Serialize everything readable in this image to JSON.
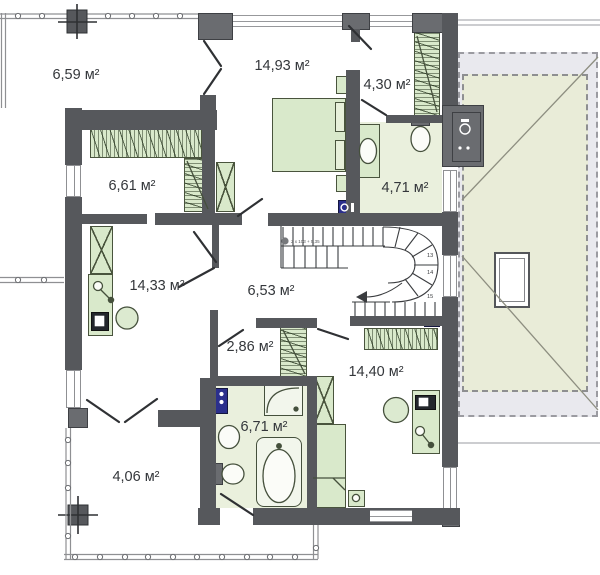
{
  "plan": {
    "title": "upper-floor-plan",
    "rooms": [
      {
        "name": "balcony-top-left",
        "area": "6,59 м²"
      },
      {
        "name": "bedroom-top",
        "area": "14,93 м²"
      },
      {
        "name": "wardrobe-top-right",
        "area": "4,30 м²"
      },
      {
        "name": "bathroom-right",
        "area": "4,71 м²"
      },
      {
        "name": "walk-in-closet-left",
        "area": "6,61 м²"
      },
      {
        "name": "room-left",
        "area": "14,33 м²"
      },
      {
        "name": "hallway-center",
        "area": "6,53 м²"
      },
      {
        "name": "closet-center",
        "area": "2,86 м²"
      },
      {
        "name": "bedroom-bottom-right",
        "area": "14,40 м²"
      },
      {
        "name": "bathroom-bottom",
        "area": "6,71 м²"
      },
      {
        "name": "terrace-bottom-left",
        "area": "4,06 м²"
      }
    ],
    "stairs": {
      "steps": [
        "13",
        "14",
        "15"
      ],
      "note": "2 x 103 + 5,35"
    },
    "colors": {
      "wall": "#56585c",
      "furniture": "#d9e9cb",
      "bath_floor": "#eaf0dd",
      "roof_outer": "#e9e9ee",
      "roof_inner": "#e9ecd8",
      "appliance_blue": "#2b2f8c"
    }
  }
}
